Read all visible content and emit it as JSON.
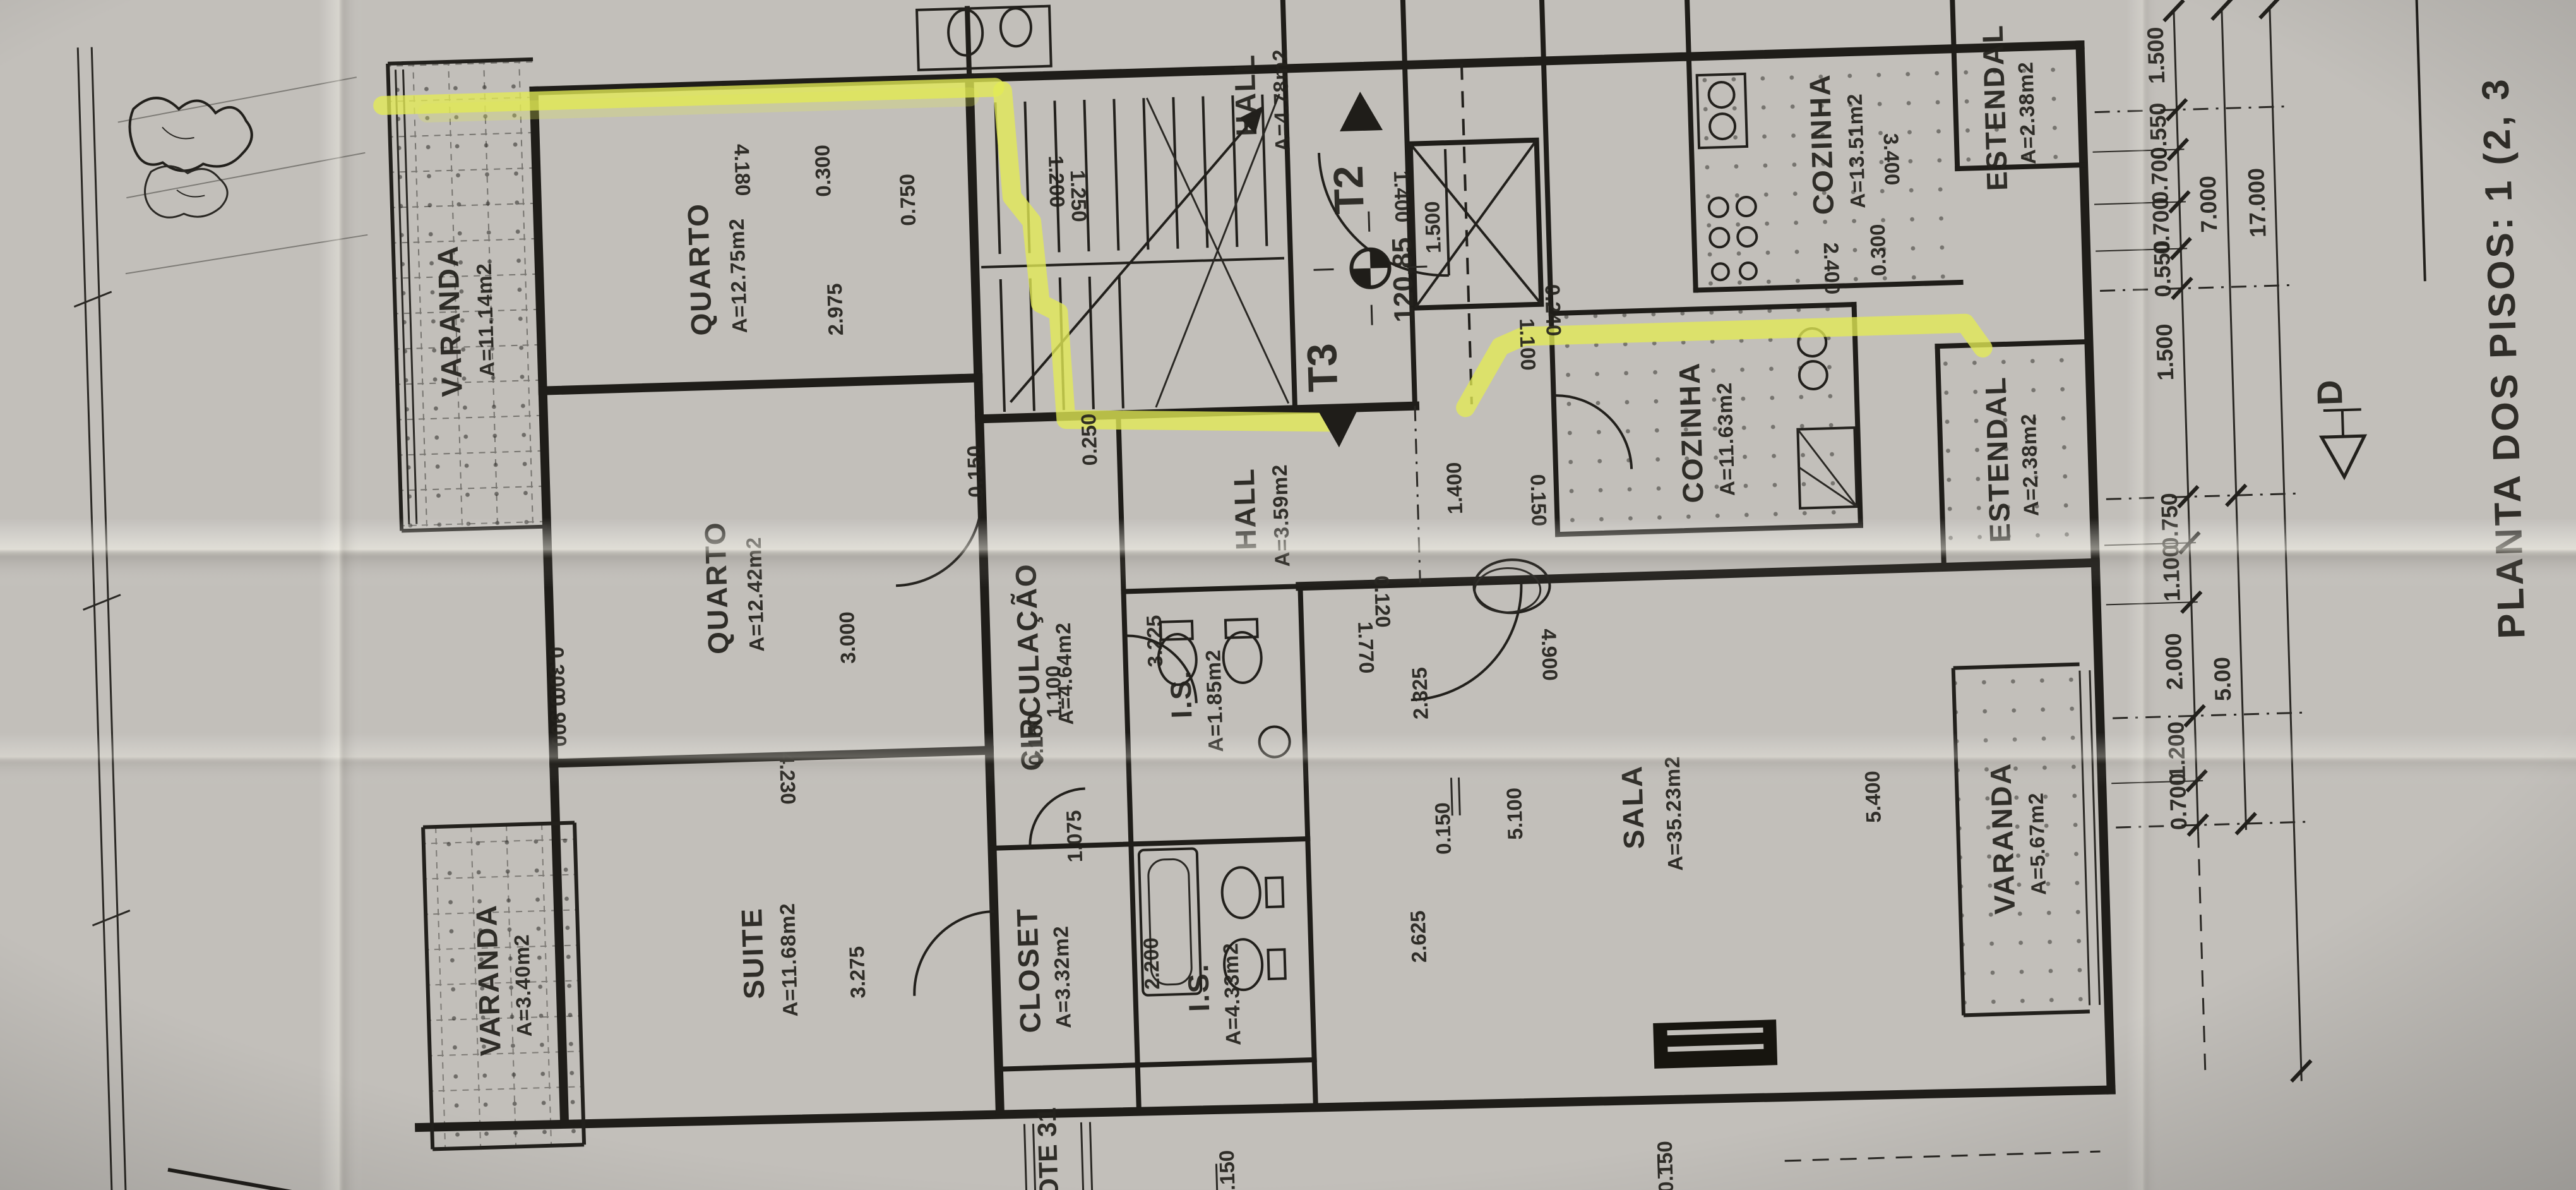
{
  "document": {
    "title": "PLANTA DOS PISOS: 1 (2, 3",
    "lot_label": "LOTE 31",
    "section_marker": "D",
    "paper_color": "#c2bfba",
    "ink_color": "#1c1c1c",
    "highlighter_color": "#e3ea55"
  },
  "unit_markers": {
    "t2": "T2",
    "t3": "T3",
    "elevation": "120.85"
  },
  "rooms": [
    {
      "id": "varanda-tl",
      "name": "VARANDA",
      "area": "A=11.14m2"
    },
    {
      "id": "quarto-1",
      "name": "QUARTO",
      "area": "A=12.75m2"
    },
    {
      "id": "quarto-2",
      "name": "QUARTO",
      "area": "A=12.42m2"
    },
    {
      "id": "suite",
      "name": "SUITE",
      "area": "A=11.68m2"
    },
    {
      "id": "closet",
      "name": "CLOSET",
      "area": "A=3.32m2"
    },
    {
      "id": "circulacao",
      "name": "CIRCULAÇÃO",
      "area": "A=4.64m2"
    },
    {
      "id": "is-1",
      "name": "I.S.",
      "area": "A=1.85m2"
    },
    {
      "id": "is-2",
      "name": "I.S.",
      "area": "A=4.33m2"
    },
    {
      "id": "hall-unit",
      "name": "HALL",
      "area": "A=3.59m2"
    },
    {
      "id": "hall-common",
      "name": "HALL",
      "area": "A=4.78m2"
    },
    {
      "id": "sala",
      "name": "SALA",
      "area": "A=35.23m2"
    },
    {
      "id": "cozinha-1",
      "name": "COZINHA",
      "area": "A=13.51m2"
    },
    {
      "id": "cozinha-2",
      "name": "COZINHA",
      "area": "A=11.63m2"
    },
    {
      "id": "estendal-1",
      "name": "ESTENDAL",
      "area": "A=2.38m2"
    },
    {
      "id": "estendal-2",
      "name": "ESTENDAL",
      "area": "A=2.38m2"
    },
    {
      "id": "varanda-right",
      "name": "VARANDA",
      "area": "A=5.67m2"
    },
    {
      "id": "varanda-bl",
      "name": "VARANDA",
      "area": "A=3.40m2"
    }
  ],
  "dimensions": {
    "right_chain_inner": [
      "1.500",
      "0.550",
      "0.700",
      "0.700",
      "0.550",
      "1.500",
      "0.750",
      "1.100",
      "2.000",
      "1.200",
      "0.700"
    ],
    "right_chain_mid": [
      "7.000",
      "5.00"
    ],
    "right_chain_outer": [
      "17.000"
    ],
    "interior": [
      "4.180",
      "2.975",
      "0.300",
      "3.000",
      "4.230",
      "3.275",
      "2.200",
      "3.225",
      "1.075",
      "1.100",
      "0.150",
      "2.325",
      "2.625",
      "0.150",
      "5.100",
      "4.900",
      "5.400",
      "1.770",
      "0.120",
      "2.400",
      "3.400",
      "0.300",
      "1.400",
      "1.400",
      "1.500",
      "1.100",
      "0.240",
      "0.150",
      "0.750",
      "1.200",
      "1.250",
      "0.250",
      "0.150",
      "0.300",
      "0.900",
      "0.150",
      "0.150"
    ]
  }
}
